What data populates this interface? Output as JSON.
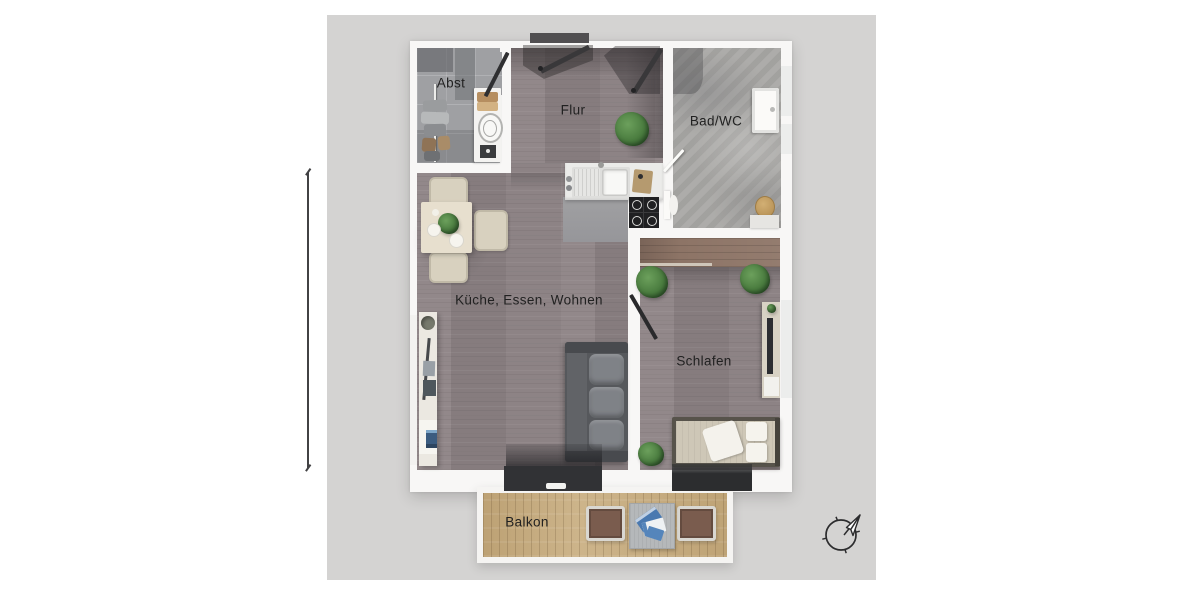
{
  "scene": {
    "background_color": "#ffffff",
    "board_color": "#d4d3d2"
  },
  "floor_plan": {
    "rooms": [
      {
        "id": "abst",
        "label": "Abst"
      },
      {
        "id": "flur",
        "label": "Flur"
      },
      {
        "id": "bad-wc",
        "label": "Bad/WC"
      },
      {
        "id": "kueche-essen-wohnen",
        "label": "Küche, Essen, Wohnen"
      },
      {
        "id": "schlafen",
        "label": "Schlafen"
      },
      {
        "id": "balkon",
        "label": "Balkon"
      }
    ],
    "palette": {
      "wall": "#f8f7f6",
      "wood_floor": "#8d8385",
      "bedroom_floor": "#928888",
      "abst_tile": "#9fa0a3",
      "bad_tile": "#a9a8a5",
      "wardrobe_wood": "#8d7466",
      "balcony_wood": "#c8ad7f",
      "sofa": "#56585c",
      "door_dark": "#39383a",
      "label_text": "#212121",
      "compass_stroke": "#2c2c2e"
    },
    "icons": {
      "compass": "compass-north-arrow-icon"
    }
  }
}
